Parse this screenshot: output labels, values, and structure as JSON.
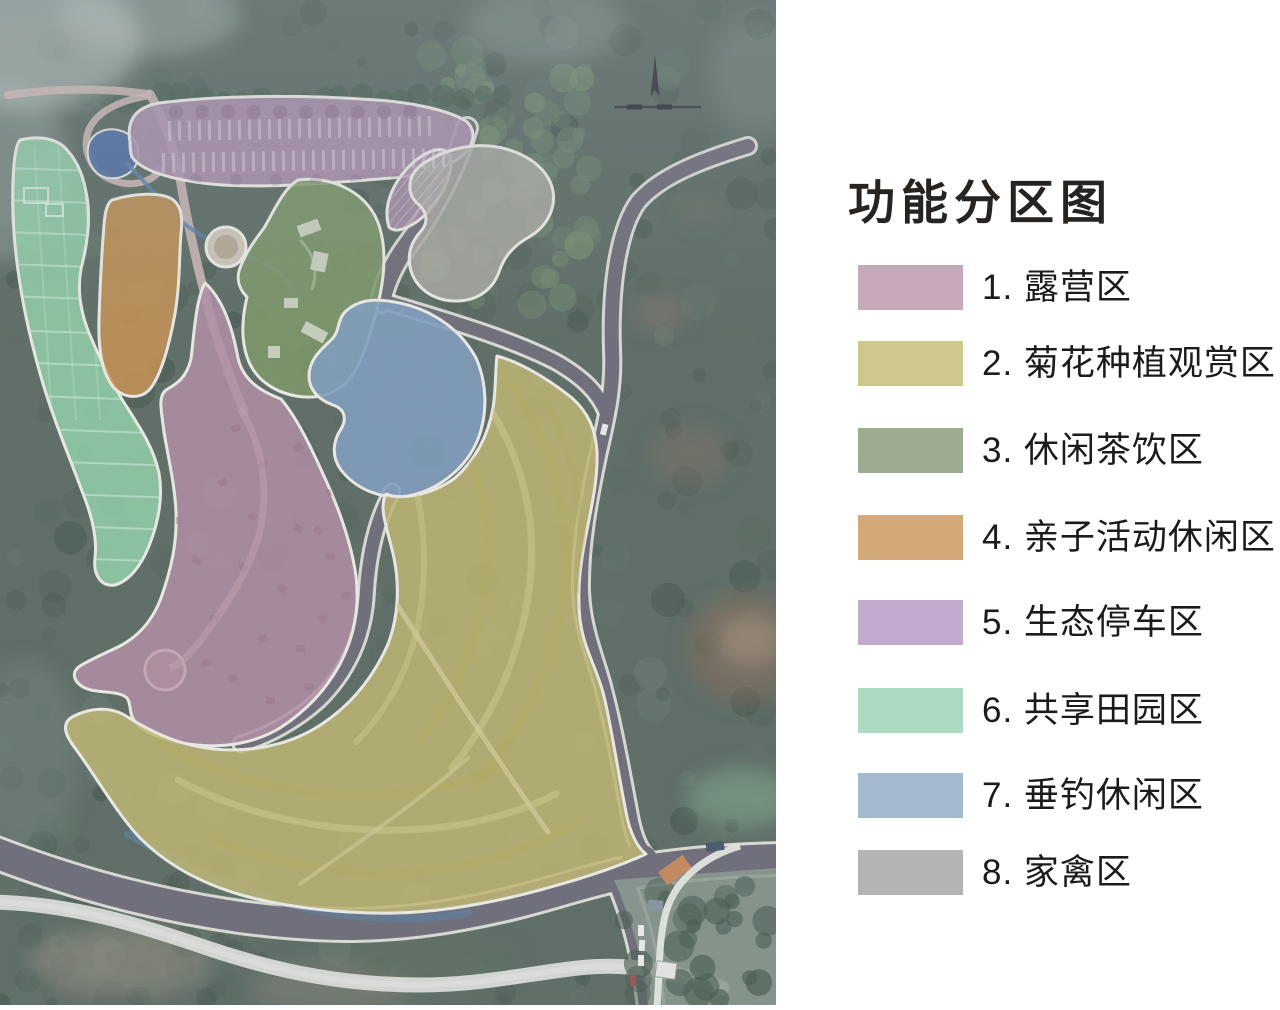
{
  "title": "功能分区图",
  "legend": [
    {
      "label": "1. 露营区",
      "swatch": "#c6a9bb",
      "map_fill": "#b48ea6"
    },
    {
      "label": "2. 菊花种植观赏区",
      "swatch": "#cec78e",
      "map_fill": "#c2b96e"
    },
    {
      "label": "3. 休闲茶饮区",
      "swatch": "#9dac91",
      "map_fill": "#7d9965"
    },
    {
      "label": "4. 亲子活动休闲区",
      "swatch": "#d3a979",
      "map_fill": "#c8914e"
    },
    {
      "label": "5. 生态停车区",
      "swatch": "#c1accd",
      "map_fill": "#b092b0"
    },
    {
      "label": "6. 共享田园区",
      "swatch": "#abdcc2",
      "map_fill": "#93d5ac"
    },
    {
      "label": "7. 垂钓休闲区",
      "swatch": "#a4b8cf",
      "map_fill": "#7f9dc0"
    },
    {
      "label": "8. 家禽区",
      "swatch": "#b4b4b5",
      "map_fill": "#adaca4"
    }
  ]
}
